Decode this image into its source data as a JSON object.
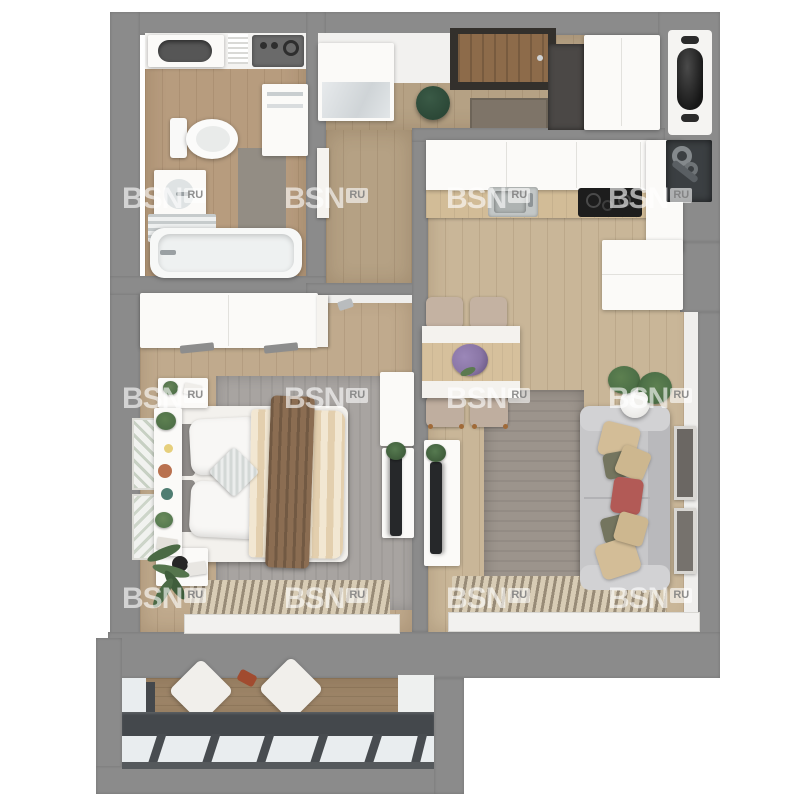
{
  "watermark": {
    "brand": "BSN",
    "suffix": "RU",
    "grid": {
      "col_lefts": [
        122,
        284,
        446,
        608,
        770
      ],
      "row_tops": [
        184,
        384,
        584
      ]
    }
  },
  "palette": {
    "background": "#ffffff",
    "wall": "#8b8b8b",
    "wall_face": "#efeeec",
    "wood_entry": "#b5a184",
    "wood_bath": "#b79c7e",
    "wood_kitchen": "#c9b698",
    "wood_bedroom": "#c0aa8d",
    "wood_balcony": "#9d8568",
    "rug_living": "#9c948c",
    "rug_bedroom": "#a8a4a1",
    "sofa": "#c7c7c9",
    "pillow_beige": "#d3bd97",
    "pillow_olive": "#74755f",
    "pillow_red": "#b25a56",
    "duvet": "#ecdcc3",
    "throw": "#8b6d52",
    "pouf_green": "#2c4837",
    "flowers_purple": "#8a76a6",
    "plant_green": "#4e7148",
    "appliance_dark": "#1d1d1d",
    "counter_wood": "#d2bc97",
    "glass": "#e9edef",
    "glazing_frame": "#44484c",
    "door_wood": "#8d6b4a"
  },
  "scene": {
    "type": "apartment-floor-plan-3d-top-view",
    "rooms": [
      {
        "name": "bathroom",
        "items": [
          "vanity-sink",
          "washing-machine",
          "storage-cabinet",
          "toilet",
          "washbasin",
          "towel-rail",
          "bath-mat",
          "bathtub",
          "door"
        ]
      },
      {
        "name": "entry-hall",
        "items": [
          "hall-wardrobe",
          "entrance-door",
          "dark-cabinet",
          "green-pouf",
          "door-mat",
          "tall-wardrobe"
        ]
      },
      {
        "name": "kitchen",
        "items": [
          "upper-cabinets",
          "counter",
          "sink",
          "cooktop",
          "side-cabinet",
          "island-cabinet"
        ]
      },
      {
        "name": "dining-area",
        "items": [
          "table",
          "table-runners",
          "flower-bouquet",
          "chair",
          "chair",
          "chair",
          "chair"
        ]
      },
      {
        "name": "living-room",
        "items": [
          "rug",
          "sofa",
          "cushions",
          "side-table",
          "potted-plants",
          "tv-console",
          "tv",
          "wall-art",
          "wall-art",
          "radiator",
          "window-sill"
        ]
      },
      {
        "name": "bedroom",
        "items": [
          "wardrobe",
          "double-bed",
          "pillows",
          "accent-pillow",
          "duvet",
          "throw-blanket",
          "headboard-console",
          "nightstand",
          "nightstand",
          "rug",
          "tv-cabinet",
          "tv",
          "wall-frames",
          "floor-plant",
          "radiator",
          "window-sill",
          "door"
        ]
      },
      {
        "name": "balcony",
        "items": [
          "deck",
          "floor-cushion",
          "floor-cushion",
          "glazing",
          "side-panel"
        ]
      },
      {
        "name": "service",
        "items": [
          "decor-niche",
          "utility-shaft-pipes"
        ]
      }
    ]
  }
}
